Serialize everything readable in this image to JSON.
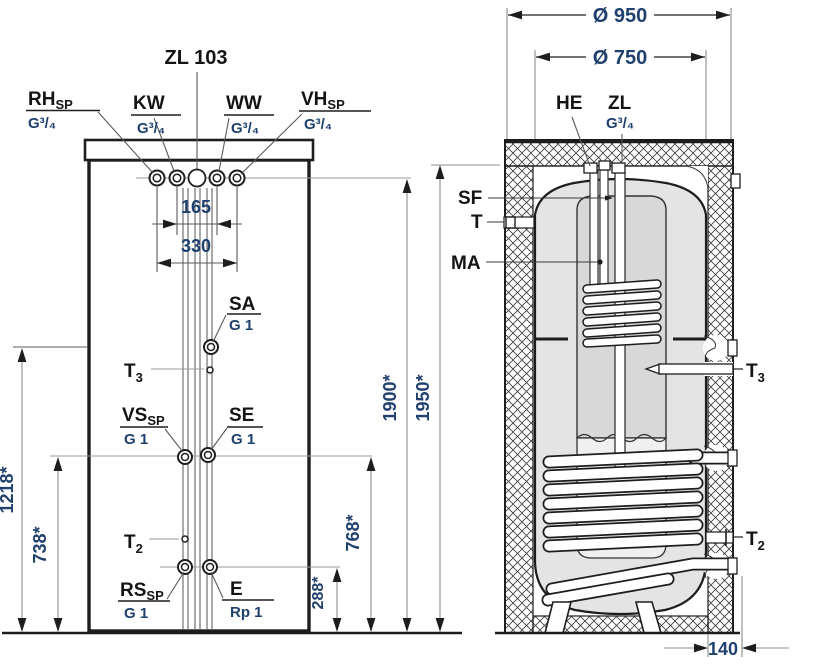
{
  "front": {
    "zl_top": "ZL 103",
    "rh": {
      "main": "RH",
      "sub": "SP",
      "size": "G³/₄"
    },
    "kw": {
      "main": "KW",
      "size": "G³/₄"
    },
    "ww": {
      "main": "WW",
      "size": "G³/₄"
    },
    "vh": {
      "main": "VH",
      "sub": "SP",
      "size": "G³/₄"
    },
    "sa": {
      "main": "SA",
      "size": "G 1"
    },
    "t3": {
      "main": "T",
      "sub": "3"
    },
    "vs": {
      "main": "VS",
      "sub": "SP",
      "size": "G 1"
    },
    "se": {
      "main": "SE",
      "size": "G 1"
    },
    "t2": {
      "main": "T",
      "sub": "2"
    },
    "rs": {
      "main": "RS",
      "sub": "SP",
      "size": "G 1"
    },
    "e": {
      "main": "E",
      "size": "Rp 1"
    },
    "dim_165": "165",
    "dim_330": "330",
    "dim_1218": "1218*",
    "dim_738": "738*",
    "dim_288": "288*",
    "dim_768": "768*",
    "dim_1900": "1900*",
    "dim_1950": "1950*"
  },
  "section": {
    "dim_950": "Ø 950",
    "dim_750": "Ø 750",
    "dim_140": "140",
    "he": "HE",
    "zl": {
      "main": "ZL",
      "size": "G³/₄"
    },
    "sf": "SF",
    "t": "T",
    "ma": "MA",
    "t3": {
      "main": "T",
      "sub": "3"
    },
    "t2": {
      "main": "T",
      "sub": "2"
    }
  },
  "colors": {
    "line": "#1d1d1d",
    "dim_text": "#20406e",
    "label_text": "#141414",
    "leader": "#8c8c8c",
    "tank_fill": "#e4e4e4",
    "inner_fill_top": "#d8d8d8",
    "inner_fill_bottom": "#f0f0f0"
  }
}
